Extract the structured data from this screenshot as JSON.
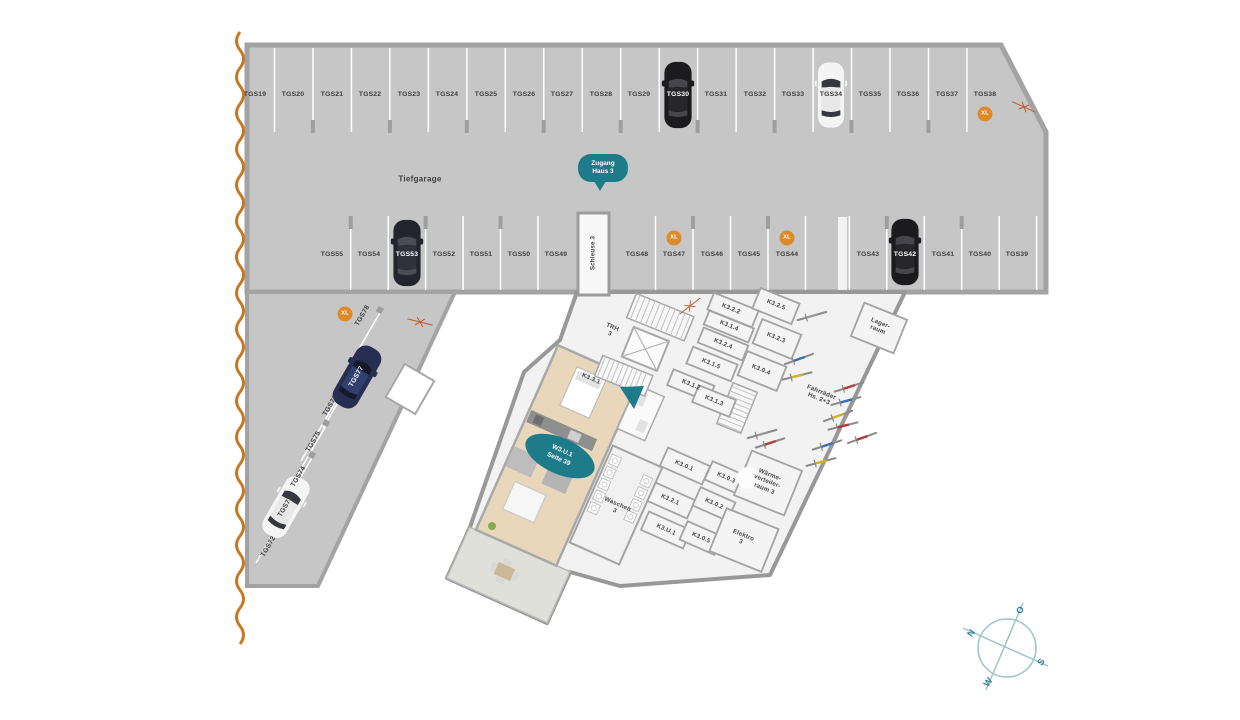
{
  "plan": {
    "garage_label": "Tiefgarage",
    "badges": {
      "zugang": {
        "line1": "Zugang",
        "line2": "Haus 3"
      },
      "apartment": {
        "line1": "W3.U.1",
        "line2": "Seite 39"
      }
    },
    "parking": {
      "row_top": [
        {
          "label": "TGS19",
          "x": 255,
          "y": 95
        },
        {
          "label": "TGS20",
          "x": 293,
          "y": 95
        },
        {
          "label": "TGS21",
          "x": 332,
          "y": 95
        },
        {
          "label": "TGS22",
          "x": 370,
          "y": 95
        },
        {
          "label": "TGS23",
          "x": 409,
          "y": 95
        },
        {
          "label": "TGS24",
          "x": 447,
          "y": 95
        },
        {
          "label": "TGS25",
          "x": 486,
          "y": 95
        },
        {
          "label": "TGS26",
          "x": 524,
          "y": 95
        },
        {
          "label": "TGS27",
          "x": 562,
          "y": 95
        },
        {
          "label": "TGS28",
          "x": 601,
          "y": 95
        },
        {
          "label": "TGS29",
          "x": 639,
          "y": 95
        },
        {
          "label": "TGS30",
          "x": 678,
          "y": 95,
          "cls": "w"
        },
        {
          "label": "TGS31",
          "x": 716,
          "y": 95
        },
        {
          "label": "TGS32",
          "x": 755,
          "y": 95
        },
        {
          "label": "TGS33",
          "x": 793,
          "y": 95
        },
        {
          "label": "TGS34",
          "x": 831,
          "y": 95
        },
        {
          "label": "TGS35",
          "x": 870,
          "y": 95
        },
        {
          "label": "TGS36",
          "x": 908,
          "y": 95
        },
        {
          "label": "TGS37",
          "x": 947,
          "y": 95
        },
        {
          "label": "TGS38",
          "x": 985,
          "y": 95
        }
      ],
      "row_middle": [
        {
          "label": "TGS55",
          "x": 332,
          "y": 255
        },
        {
          "label": "TGS54",
          "x": 369,
          "y": 255
        },
        {
          "label": "TGS53",
          "x": 407,
          "y": 255,
          "cls": "w"
        },
        {
          "label": "TGS52",
          "x": 444,
          "y": 255
        },
        {
          "label": "TGS51",
          "x": 481,
          "y": 255
        },
        {
          "label": "TGS50",
          "x": 519,
          "y": 255
        },
        {
          "label": "TGS49",
          "x": 556,
          "y": 255
        },
        {
          "label": "TGS48",
          "x": 637,
          "y": 255
        },
        {
          "label": "TGS47",
          "x": 674,
          "y": 255
        },
        {
          "label": "TGS46",
          "x": 712,
          "y": 255
        },
        {
          "label": "TGS45",
          "x": 749,
          "y": 255
        },
        {
          "label": "TGS44",
          "x": 787,
          "y": 255
        },
        {
          "label": "TGS43",
          "x": 868,
          "y": 255
        },
        {
          "label": "TGS42",
          "x": 905,
          "y": 255,
          "cls": "w"
        },
        {
          "label": "TGS41",
          "x": 943,
          "y": 255
        },
        {
          "label": "TGS40",
          "x": 980,
          "y": 255
        },
        {
          "label": "TGS39",
          "x": 1017,
          "y": 255
        }
      ],
      "row_diagonal": [
        {
          "label": "TGS78",
          "x": 363,
          "y": 316,
          "rot": -60
        },
        {
          "label": "TGS77",
          "x": 357,
          "y": 377,
          "rot": -60,
          "cls": "w"
        },
        {
          "label": "TGS76",
          "x": 331,
          "y": 406,
          "rot": -60
        },
        {
          "label": "TGS75",
          "x": 314,
          "y": 442,
          "rot": -60
        },
        {
          "label": "TGS74",
          "x": 299,
          "y": 477,
          "rot": -60
        },
        {
          "label": "TGS73",
          "x": 286,
          "y": 507,
          "rot": -60
        },
        {
          "label": "TGS72",
          "x": 269,
          "y": 547,
          "rot": -60
        }
      ],
      "xl_badges": [
        {
          "label": "XL",
          "x": 985,
          "y": 114
        },
        {
          "label": "XL",
          "x": 674,
          "y": 238
        },
        {
          "label": "XL",
          "x": 787,
          "y": 238
        },
        {
          "label": "XL",
          "x": 345,
          "y": 314
        }
      ]
    },
    "rooms": [
      {
        "label": "Schleuse 3",
        "x": 593,
        "y": 253,
        "rot": -90
      },
      {
        "label": "TRH\n3",
        "x": 611,
        "y": 331,
        "rot": 22
      },
      {
        "label": "K3.3.1",
        "x": 591,
        "y": 379,
        "rot": 24
      },
      {
        "label": "K3.2.2",
        "x": 731,
        "y": 309,
        "rot": 22
      },
      {
        "label": "K3.2.5",
        "x": 776,
        "y": 305,
        "rot": 22
      },
      {
        "label": "K3.1.4",
        "x": 729,
        "y": 326,
        "rot": 22
      },
      {
        "label": "K3.2.4",
        "x": 723,
        "y": 344,
        "rot": 22
      },
      {
        "label": "K3.2.3",
        "x": 776,
        "y": 338,
        "rot": 22
      },
      {
        "label": "K3.1.5",
        "x": 711,
        "y": 364,
        "rot": 22
      },
      {
        "label": "K3.0.4",
        "x": 761,
        "y": 370,
        "rot": 22
      },
      {
        "label": "K3.1.2",
        "x": 691,
        "y": 385,
        "rot": 22
      },
      {
        "label": "K3.1.3",
        "x": 714,
        "y": 401,
        "rot": 22
      },
      {
        "label": "Lager-\nraum",
        "x": 879,
        "y": 327,
        "rot": 22
      },
      {
        "label": "Fahrräder\nHs. 2+3",
        "x": 820,
        "y": 396,
        "rot": 22
      },
      {
        "label": "K3.0.1",
        "x": 684,
        "y": 466,
        "rot": 24
      },
      {
        "label": "K3.0.3",
        "x": 726,
        "y": 478,
        "rot": 24
      },
      {
        "label": "K3.2.1",
        "x": 670,
        "y": 500,
        "rot": 24
      },
      {
        "label": "K3.0.2",
        "x": 714,
        "y": 504,
        "rot": 24
      },
      {
        "label": "K3.U.1",
        "x": 666,
        "y": 530,
        "rot": 24
      },
      {
        "label": "K3.0.5",
        "x": 701,
        "y": 538,
        "rot": 24
      },
      {
        "label": "Wärme-\nverteiler-\nraum 3",
        "x": 767,
        "y": 482,
        "rot": 22
      },
      {
        "label": "Elektro\n3",
        "x": 742,
        "y": 539,
        "rot": 22
      },
      {
        "label": "Waschen\n3",
        "x": 616,
        "y": 508,
        "rot": 24
      }
    ],
    "compass": {
      "n": "N",
      "o": "O",
      "s": "S",
      "w": "W"
    },
    "colors": {
      "teal": "#1d7b8a",
      "orange_xl": "#dd8a2b",
      "boundary_orange": "#c8791f",
      "garage_gray": "#c6c6c6"
    }
  }
}
